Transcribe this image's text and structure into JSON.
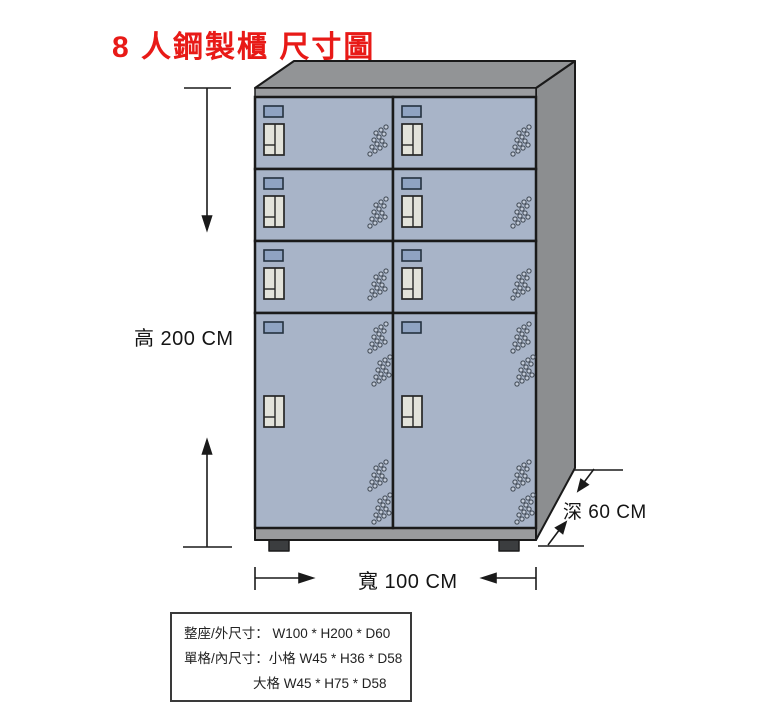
{
  "title": "8 人鋼製櫃 尺寸圖",
  "dimensions": {
    "height": "高 200 CM",
    "width": "寬 100 CM",
    "depth": "深 60 CM"
  },
  "spec_box": {
    "line_overall": "整座/外尺寸： W100 * H200 * D60",
    "line_small": "單格/內尺寸：小格 W45 * H36 * D58",
    "line_large": "大格 W45 * H75 * D58"
  },
  "cabinet": {
    "compartments": 8,
    "columns": 2,
    "small_door_rows": 3,
    "large_door_rows": 1
  },
  "colors": {
    "title_red": "#e81a17",
    "door_blue": "#a8b4c8",
    "metal_gray": "#929496",
    "outline": "#1a1a1a"
  }
}
